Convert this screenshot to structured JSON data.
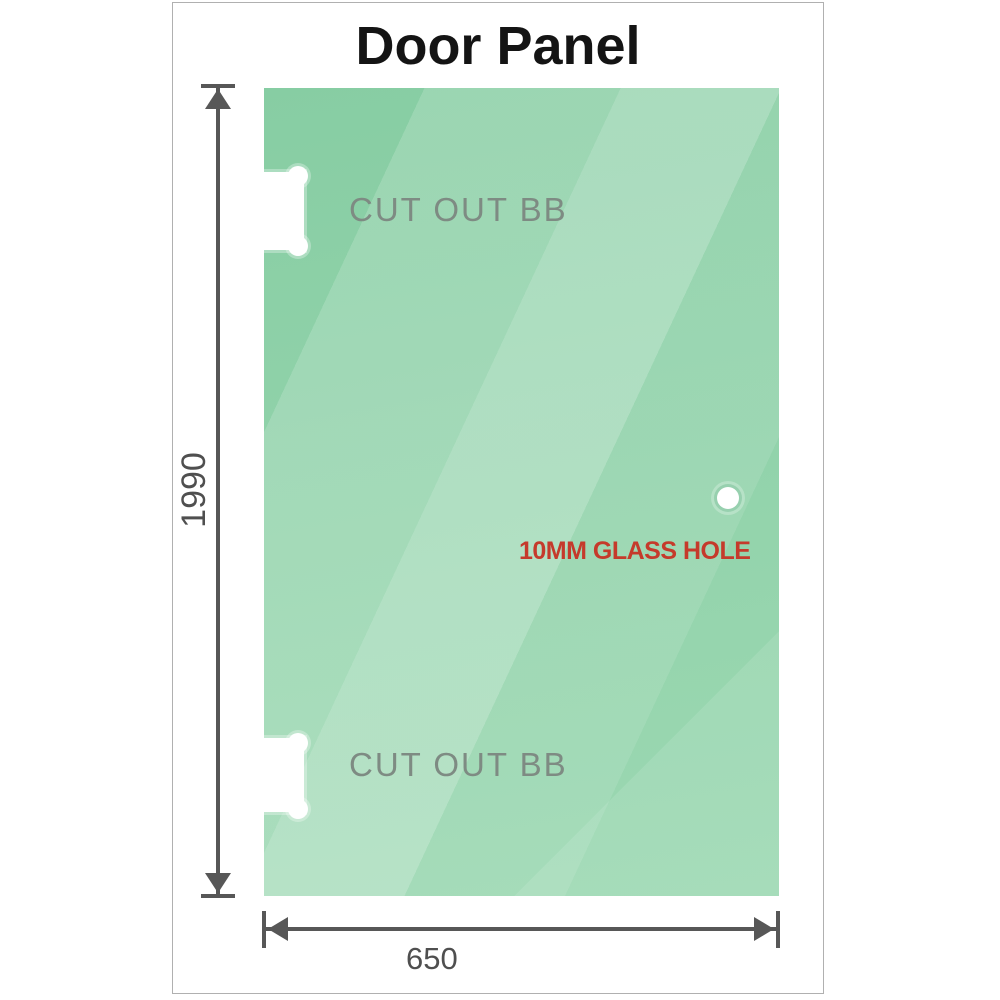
{
  "title": "Door Panel",
  "panel": {
    "cutout_top_label": "CUT OUT BB",
    "cutout_bottom_label": "CUT OUT BB",
    "glass_hole_label": "10MM GLASS HOLE"
  },
  "dimensions": {
    "height_label": "1990",
    "width_label": "650"
  },
  "colors": {
    "glass_base_dark": "#87cda3",
    "glass_base_mid": "#92d3ab",
    "glass_base_light": "#9cd8b2",
    "dim_line": "#575757",
    "dim_text": "#4f4f4f",
    "cutout_text": "#7e8b83",
    "hole_text": "#c53a2b",
    "title_text": "#141414",
    "frame_border": "#b0b0b0"
  }
}
